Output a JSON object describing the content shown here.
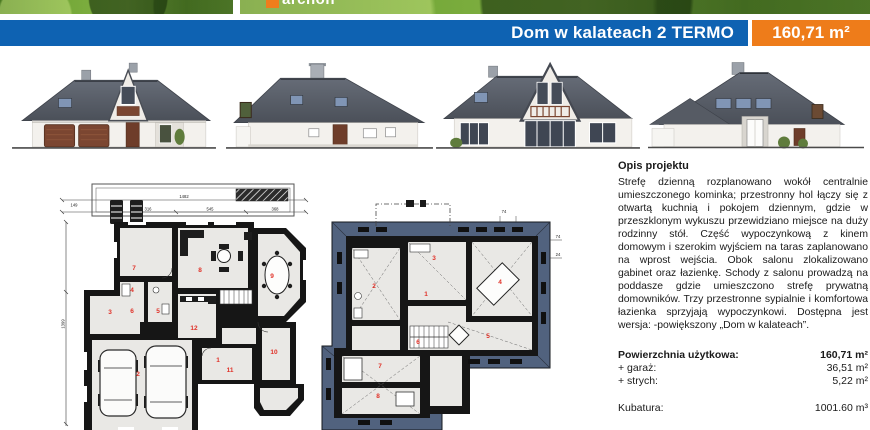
{
  "header": {
    "title": "Dom w kalateach 2 TERMO",
    "area_badge": "160,71 m²",
    "watermark_logo": "archon",
    "colors": {
      "bar_blue": "#0e62b2",
      "badge_orange": "#ee7c1a"
    }
  },
  "description": {
    "heading": "Opis projektu",
    "body": "Strefę dzienną rozplanowano wokół centralnie umieszczonego kominka; przestronny hol łączy się z otwartą kuchnią i pokojem dziennym, gdzie w przeszklonym wykuszu przewidziano miejsce na duży rodzinny stół. Część wypoczynkową z kinem domowym i szerokim wyjściem na taras zaplanowano na wprost wejścia. Obok salonu zlokalizowano gabinet oraz łazienkę. Schody z salonu prowadzą na poddasze gdzie umieszczono strefę prywatną domowników. Trzy przestronne sypialnie i komfortowa łazienka sprzyjają wypoczynkowi. Dostępna jest wersja: -powiększony „Dom w kalateach”."
  },
  "specs": {
    "rows": [
      {
        "label": "Powierzchnia użytkowa:",
        "value": "160,71 m²"
      },
      {
        "label": "+ garaż:",
        "value": "36,51 m²"
      },
      {
        "label": "+ strych:",
        "value": "5,22 m²"
      }
    ],
    "kubatura_label": "Kubatura:",
    "kubatura_value": "1001.60 m³"
  },
  "plans": {
    "ground": {
      "room_numbers": [
        "7",
        "8",
        "9",
        "3",
        "4",
        "6",
        "5",
        "12",
        "1",
        "2",
        "11",
        "10"
      ],
      "dimensions": {
        "total": "1482",
        "seg_a": "316",
        "seg_b": "545",
        "seg_c": "368",
        "left_total": "1399",
        "left_offset": "149"
      }
    },
    "upper": {
      "room_numbers": [
        "1",
        "2",
        "3",
        "4",
        "5",
        "6",
        "7",
        "8"
      ],
      "dimensions": [
        "74",
        "74",
        "24"
      ]
    }
  }
}
